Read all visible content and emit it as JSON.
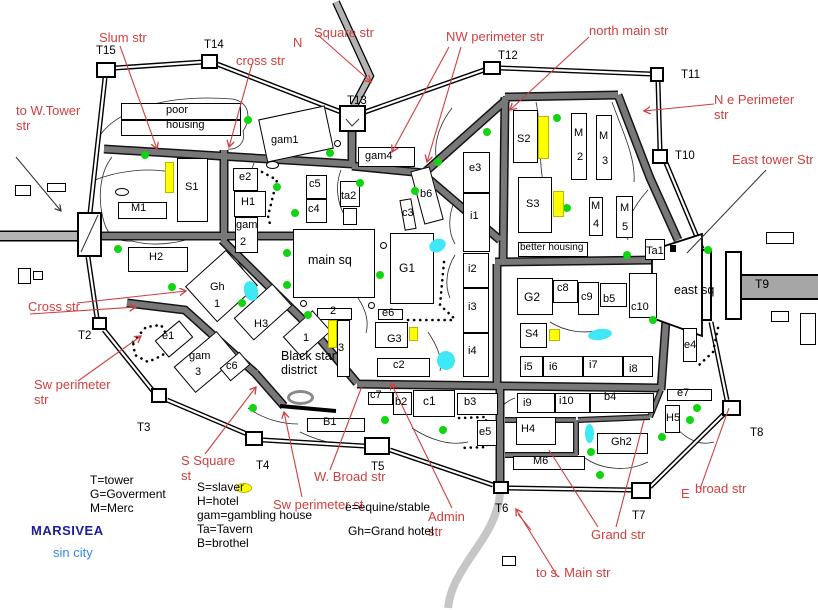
{
  "title": {
    "name": "MARSIVEA",
    "subtitle": "sin city"
  },
  "colors": {
    "red_street_label": "#cf3f3f",
    "navy_title": "#1c1ca0",
    "light_blue_subtitle": "#3b86f0",
    "inner_street": "#787878",
    "outer_road": "#b3b3b3",
    "tree": "#0fd60f",
    "pond": "#3fe8f5",
    "yellow": "#ffff00"
  },
  "legend": {
    "left": [
      "T=tower",
      "G=Goverment",
      "M=Merc"
    ],
    "middle": [
      "S=slaver",
      "H=hotel",
      "gam=gambling house",
      "Ta=Tavern",
      "B=brothel"
    ],
    "right": [
      "e=equine/stable",
      "Gh=Grand hotel"
    ]
  },
  "towers": [
    {
      "id": "T1",
      "x": 77,
      "y": 212,
      "w": 25,
      "h": 45
    },
    {
      "id": "T2",
      "x": 92,
      "y": 317,
      "w": 15,
      "h": 13
    },
    {
      "id": "T3",
      "x": 151,
      "y": 388,
      "w": 16,
      "h": 15
    },
    {
      "id": "T4",
      "x": 245,
      "y": 431,
      "w": 18,
      "h": 15
    },
    {
      "id": "T5",
      "x": 364,
      "y": 437,
      "w": 26,
      "h": 18
    },
    {
      "id": "T6",
      "x": 493,
      "y": 481,
      "w": 16,
      "h": 13
    },
    {
      "id": "T7",
      "x": 631,
      "y": 482,
      "w": 20,
      "h": 17
    },
    {
      "id": "T8",
      "x": 722,
      "y": 400,
      "w": 19,
      "h": 16
    },
    {
      "id": "T9a",
      "x": 701,
      "y": 249,
      "w": 11,
      "h": 72
    },
    {
      "id": "T9b",
      "x": 725,
      "y": 251,
      "w": 17,
      "h": 69
    },
    {
      "id": "T10",
      "x": 652,
      "y": 149,
      "w": 16,
      "h": 15
    },
    {
      "id": "T11",
      "x": 650,
      "y": 67,
      "w": 14,
      "h": 15
    },
    {
      "id": "T12",
      "x": 483,
      "y": 61,
      "w": 18,
      "h": 14
    },
    {
      "id": "T13",
      "x": 339,
      "y": 105,
      "w": 27,
      "h": 27
    },
    {
      "id": "T14",
      "x": 201,
      "y": 54,
      "w": 17,
      "h": 15
    },
    {
      "id": "T15",
      "x": 96,
      "y": 62,
      "w": 20,
      "h": 16
    }
  ],
  "buildings": [
    {
      "l": "poor",
      "x": 121,
      "y": 103,
      "w": 120,
      "h": 17,
      "lx": 166,
      "ly": 105
    },
    {
      "l": "housing",
      "x": 121,
      "y": 120,
      "w": 120,
      "h": 16,
      "lx": 166,
      "ly": 120
    },
    {
      "l": "S1",
      "x": 177,
      "y": 158,
      "w": 31,
      "h": 64,
      "lx": 185,
      "ly": 182
    },
    {
      "l": "M1",
      "x": 118,
      "y": 202,
      "w": 49,
      "h": 17,
      "lx": 131,
      "ly": 203
    },
    {
      "l": "H2",
      "x": 128,
      "y": 247,
      "w": 60,
      "h": 25,
      "lx": 149,
      "ly": 252
    },
    {
      "l": "e2",
      "x": 233,
      "y": 168,
      "w": 25,
      "h": 23,
      "lx": 239,
      "ly": 172
    },
    {
      "l": "H1",
      "x": 234,
      "y": 191,
      "w": 32,
      "h": 26,
      "lx": 241,
      "ly": 197
    },
    {
      "l": "gam",
      "l2": "2",
      "x": 235,
      "y": 217,
      "w": 23,
      "h": 36,
      "lx": 236,
      "ly": 220,
      "l2x": 240,
      "l2y": 237
    },
    {
      "l": "c5",
      "x": 306,
      "y": 175,
      "w": 21,
      "h": 24,
      "lx": 309,
      "ly": 179
    },
    {
      "l": "c4",
      "x": 306,
      "y": 199,
      "w": 21,
      "h": 24,
      "lx": 308,
      "ly": 204
    },
    {
      "l": "ta2",
      "x": 340,
      "y": 181,
      "w": 20,
      "h": 26,
      "lx": 341,
      "ly": 191
    },
    {
      "x": 343,
      "y": 208,
      "w": 14,
      "h": 17
    },
    {
      "l": "gam1",
      "x": 262,
      "y": 112,
      "w": 68,
      "h": 44,
      "r": -12,
      "lx": 271,
      "ly": 135
    },
    {
      "l": "gam4",
      "x": 358,
      "y": 147,
      "w": 57,
      "h": 20,
      "lx": 365,
      "ly": 151
    },
    {
      "l": "b6",
      "x": 417,
      "y": 168,
      "w": 20,
      "h": 55,
      "r": -15,
      "lx": 420,
      "ly": 189
    },
    {
      "l": "c3",
      "x": 402,
      "y": 199,
      "w": 12,
      "h": 31,
      "r": -10,
      "lx": 402,
      "ly": 208
    },
    {
      "l": "main sq",
      "x": 293,
      "y": 229,
      "w": 82,
      "h": 69,
      "lx": 308,
      "ly": 254,
      "lfs": 12.5
    },
    {
      "l": "G1",
      "x": 390,
      "y": 233,
      "w": 44,
      "h": 71,
      "lx": 399,
      "ly": 262,
      "lfs": 12
    },
    {
      "l": "e6",
      "x": 378,
      "y": 309,
      "w": 25,
      "h": 11,
      "lx": 382,
      "ly": 308
    },
    {
      "l": "G3",
      "x": 375,
      "y": 322,
      "w": 33,
      "h": 26,
      "lx": 387,
      "ly": 334
    },
    {
      "l": "c2",
      "x": 377,
      "y": 358,
      "w": 53,
      "h": 19,
      "lx": 393,
      "ly": 360
    },
    {
      "l": "e3",
      "x": 463,
      "y": 152,
      "w": 27,
      "h": 41,
      "lx": 469,
      "ly": 163
    },
    {
      "l": "i1",
      "x": 463,
      "y": 193,
      "w": 27,
      "h": 59,
      "lx": 470,
      "ly": 211
    },
    {
      "l": "i2",
      "x": 463,
      "y": 253,
      "w": 26,
      "h": 35,
      "lx": 468,
      "ly": 264
    },
    {
      "l": "i3",
      "x": 463,
      "y": 288,
      "w": 26,
      "h": 45,
      "lx": 468,
      "ly": 302
    },
    {
      "l": "i4",
      "x": 463,
      "y": 333,
      "w": 26,
      "h": 44,
      "lx": 468,
      "ly": 346
    },
    {
      "l": "S2",
      "x": 513,
      "y": 110,
      "w": 25,
      "h": 53,
      "lx": 517,
      "ly": 134
    },
    {
      "l": "M",
      "l2": "2",
      "x": 571,
      "y": 113,
      "w": 16,
      "h": 67,
      "lx": 574,
      "ly": 128,
      "l2x": 577,
      "l2y": 152
    },
    {
      "l": "M",
      "l2": "3",
      "x": 596,
      "y": 115,
      "w": 16,
      "h": 65,
      "lx": 599,
      "ly": 131,
      "l2x": 602,
      "l2y": 156
    },
    {
      "l": "S3",
      "x": 518,
      "y": 177,
      "w": 34,
      "h": 56,
      "lx": 526,
      "ly": 199
    },
    {
      "l": "M",
      "l2": "4",
      "x": 589,
      "y": 197,
      "w": 14,
      "h": 39,
      "lx": 591,
      "ly": 201,
      "l2x": 593,
      "l2y": 219
    },
    {
      "l": "M",
      "l2": "5",
      "x": 616,
      "y": 196,
      "w": 17,
      "h": 42,
      "lx": 620,
      "ly": 203,
      "l2x": 622,
      "l2y": 222
    },
    {
      "l": "better housing",
      "x": 518,
      "y": 242,
      "w": 70,
      "h": 15,
      "lx": 520,
      "ly": 243,
      "lfs": 10
    },
    {
      "l": "Ta1",
      "x": 645,
      "y": 239,
      "w": 20,
      "h": 21,
      "lx": 646,
      "ly": 246
    },
    {
      "l": "G2",
      "x": 517,
      "y": 278,
      "w": 36,
      "h": 37,
      "lx": 524,
      "ly": 291,
      "lfs": 12
    },
    {
      "l": "c8",
      "x": 553,
      "y": 280,
      "w": 25,
      "h": 23,
      "lx": 557,
      "ly": 283
    },
    {
      "l": "c9",
      "x": 578,
      "y": 282,
      "w": 21,
      "h": 33,
      "lx": 581,
      "ly": 292
    },
    {
      "l": "b5",
      "x": 600,
      "y": 283,
      "w": 27,
      "h": 24,
      "lx": 603,
      "ly": 294
    },
    {
      "l": "c10",
      "x": 629,
      "y": 273,
      "w": 28,
      "h": 45,
      "lx": 631,
      "ly": 302
    },
    {
      "l": "S4",
      "x": 520,
      "y": 323,
      "w": 27,
      "h": 25,
      "lx": 525,
      "ly": 329
    },
    {
      "l": "i5",
      "x": 520,
      "y": 356,
      "w": 23,
      "h": 21,
      "lx": 524,
      "ly": 362
    },
    {
      "l": "i6",
      "x": 543,
      "y": 356,
      "w": 40,
      "h": 21,
      "lx": 549,
      "ly": 362
    },
    {
      "l": "i7",
      "x": 583,
      "y": 356,
      "w": 40,
      "h": 21,
      "lx": 589,
      "ly": 360
    },
    {
      "l": "i8",
      "x": 623,
      "y": 356,
      "w": 30,
      "h": 21,
      "lx": 629,
      "ly": 364
    },
    {
      "l": "i9",
      "x": 517,
      "y": 393,
      "w": 38,
      "h": 20,
      "lx": 523,
      "ly": 398
    },
    {
      "l": "i10",
      "x": 555,
      "y": 393,
      "w": 35,
      "h": 20,
      "lx": 559,
      "ly": 396
    },
    {
      "l": "b4",
      "x": 590,
      "y": 393,
      "w": 64,
      "h": 20,
      "lx": 604,
      "ly": 392
    },
    {
      "l": "H4",
      "x": 516,
      "y": 417,
      "w": 40,
      "h": 28,
      "lx": 521,
      "ly": 424
    },
    {
      "l": "M6",
      "x": 513,
      "y": 456,
      "w": 72,
      "h": 14,
      "lx": 533,
      "ly": 456
    },
    {
      "l": "Gh2",
      "x": 597,
      "y": 433,
      "w": 51,
      "h": 21,
      "lx": 611,
      "ly": 437
    },
    {
      "l": "H5",
      "x": 665,
      "y": 405,
      "w": 15,
      "h": 28,
      "lx": 666,
      "ly": 413
    },
    {
      "l": "e7",
      "x": 667,
      "y": 389,
      "w": 45,
      "h": 12,
      "lx": 677,
      "ly": 388
    },
    {
      "l": "e4",
      "x": 683,
      "y": 328,
      "w": 14,
      "h": 34,
      "lx": 684,
      "ly": 340
    },
    {
      "l": "e5",
      "x": 477,
      "y": 420,
      "w": 20,
      "h": 26,
      "lx": 479,
      "ly": 427
    },
    {
      "l": "c7",
      "x": 368,
      "y": 392,
      "w": 25,
      "h": 13,
      "lx": 370,
      "ly": 390
    },
    {
      "l": "b2",
      "x": 393,
      "y": 392,
      "w": 19,
      "h": 23,
      "lx": 395,
      "ly": 397
    },
    {
      "l": "c1",
      "x": 413,
      "y": 390,
      "w": 42,
      "h": 27,
      "lx": 423,
      "ly": 395,
      "lfs": 12
    },
    {
      "l": "b3",
      "x": 457,
      "y": 393,
      "w": 41,
      "h": 22,
      "lx": 464,
      "ly": 397
    },
    {
      "l": "B1",
      "x": 307,
      "y": 418,
      "w": 58,
      "h": 14,
      "lx": 323,
      "ly": 417
    },
    {
      "l": "2",
      "x": 317,
      "y": 308,
      "w": 35,
      "h": 12,
      "lx": 330,
      "ly": 306
    },
    {
      "l": "3",
      "x": 337,
      "y": 320,
      "w": 13,
      "h": 57,
      "lx": 338,
      "ly": 343
    },
    {
      "l": "1",
      "x": 287,
      "y": 320,
      "w": 40,
      "h": 28,
      "r": -42,
      "lx": 303,
      "ly": 333
    },
    {
      "l": "Gh",
      "l2": "1",
      "x": 194,
      "y": 262,
      "w": 55,
      "h": 48,
      "r": -42,
      "lx": 210,
      "ly": 282,
      "l2x": 214,
      "l2y": 299
    },
    {
      "l": "H3",
      "x": 237,
      "y": 297,
      "w": 52,
      "h": 30,
      "r": -42,
      "lx": 254,
      "ly": 319
    },
    {
      "l": "e1",
      "x": 158,
      "y": 328,
      "w": 32,
      "h": 22,
      "r": -40,
      "lx": 162,
      "ly": 331
    },
    {
      "l": "gam",
      "l2": "3",
      "x": 178,
      "y": 345,
      "w": 56,
      "h": 34,
      "r": -40,
      "lx": 189,
      "ly": 351,
      "l2x": 195,
      "l2y": 367
    },
    {
      "l": "c6",
      "x": 222,
      "y": 358,
      "w": 26,
      "h": 17,
      "r": -40,
      "lx": 226,
      "ly": 361
    }
  ],
  "outbuildings": [
    {
      "x": 15,
      "y": 185,
      "w": 16,
      "h": 11
    },
    {
      "x": 47,
      "y": 183,
      "w": 19,
      "h": 9
    },
    {
      "x": 18,
      "y": 268,
      "w": 13,
      "h": 16
    },
    {
      "x": 33,
      "y": 271,
      "w": 10,
      "h": 9
    },
    {
      "x": 766,
      "y": 232,
      "w": 28,
      "h": 12
    },
    {
      "x": 771,
      "y": 311,
      "w": 18,
      "h": 11
    },
    {
      "x": 800,
      "y": 313,
      "w": 16,
      "h": 32
    },
    {
      "x": 502,
      "y": 556,
      "w": 14,
      "h": 10
    }
  ],
  "black_squares": [
    {
      "x": 670,
      "y": 245,
      "w": 6,
      "h": 7
    }
  ],
  "trees": [
    [
      145,
      155
    ],
    [
      248,
      120
    ],
    [
      330,
      153
    ],
    [
      438,
      162
    ],
    [
      557,
      118
    ],
    [
      487,
      132
    ],
    [
      567,
      208
    ],
    [
      277,
      187
    ],
    [
      360,
      183
    ],
    [
      415,
      191
    ],
    [
      295,
      213
    ],
    [
      118,
      249
    ],
    [
      172,
      287
    ],
    [
      287,
      253
    ],
    [
      287,
      285
    ],
    [
      380,
      275
    ],
    [
      242,
      303
    ],
    [
      627,
      255
    ],
    [
      653,
      320
    ],
    [
      708,
      250
    ],
    [
      308,
      315
    ],
    [
      253,
      408
    ],
    [
      385,
      420
    ],
    [
      443,
      430
    ],
    [
      697,
      408
    ],
    [
      690,
      420
    ],
    [
      662,
      437
    ],
    [
      591,
      452
    ],
    [
      600,
      475
    ]
  ],
  "ponds": [
    {
      "x": 244,
      "y": 281,
      "w": 14,
      "h": 20,
      "r": -15
    },
    {
      "x": 429,
      "y": 239,
      "w": 17,
      "h": 13,
      "r": -25
    },
    {
      "x": 437,
      "y": 351,
      "w": 18,
      "h": 19,
      "r": 0
    },
    {
      "x": 588,
      "y": 329,
      "w": 24,
      "h": 11,
      "r": -8
    },
    {
      "x": 585,
      "y": 424,
      "w": 9,
      "h": 19,
      "r": 0
    }
  ],
  "yellow_marks": [
    {
      "x": 165,
      "y": 162,
      "w": 9,
      "h": 31
    },
    {
      "x": 538,
      "y": 116,
      "w": 11,
      "h": 43
    },
    {
      "x": 553,
      "y": 191,
      "w": 11,
      "h": 26
    },
    {
      "x": 549,
      "y": 329,
      "w": 11,
      "h": 12
    },
    {
      "x": 328,
      "y": 320,
      "w": 9,
      "h": 28
    },
    {
      "x": 409,
      "y": 327,
      "w": 9,
      "h": 14
    },
    {
      "x": 236,
      "y": 483,
      "w": 16,
      "h": 10,
      "round": 1
    }
  ],
  "circles": [
    [
      371,
      305
    ],
    [
      383,
      245
    ],
    [
      337,
      143
    ],
    [
      303,
      303
    ]
  ],
  "ovals": [
    {
      "x": 115,
      "y": 188,
      "w": 14,
      "h": 8
    },
    {
      "x": 266,
      "y": 161,
      "w": 13,
      "h": 8
    }
  ],
  "gray_oval": {
    "x": 287,
    "y": 390,
    "w": 27,
    "h": 15
  },
  "labels": [
    {
      "t": "Slum str",
      "x": 99,
      "y": 31,
      "c": "red",
      "fs": 13
    },
    {
      "t": "cross str",
      "x": 236,
      "y": 54,
      "c": "red",
      "fs": 13
    },
    {
      "t": "N",
      "x": 293,
      "y": 36,
      "c": "red",
      "fs": 13
    },
    {
      "t": "Square str",
      "x": 314,
      "y": 26,
      "c": "red",
      "fs": 13
    },
    {
      "t": "NW perimeter str",
      "x": 446,
      "y": 30,
      "c": "red",
      "fs": 13
    },
    {
      "t": "north main str",
      "x": 589,
      "y": 24,
      "c": "red",
      "fs": 13
    },
    {
      "t": "N e Perimeter\nstr",
      "x": 714,
      "y": 93,
      "c": "red",
      "fs": 13
    },
    {
      "t": "East tower Str",
      "x": 732,
      "y": 153,
      "c": "red",
      "fs": 13
    },
    {
      "t": "to W.Tower\nstr",
      "x": 16,
      "y": 104,
      "c": "red",
      "fs": 13
    },
    {
      "t": "Cross str",
      "x": 28,
      "y": 300,
      "c": "red",
      "fs": 13
    },
    {
      "t": "Sw perimeter\nstr",
      "x": 34,
      "y": 378,
      "c": "red",
      "fs": 13
    },
    {
      "t": "S Square\nst",
      "x": 181,
      "y": 454,
      "c": "red",
      "fs": 13
    },
    {
      "t": "Sw perimeter st",
      "x": 273,
      "y": 498,
      "c": "red",
      "fs": 13
    },
    {
      "t": "W. Broad str",
      "x": 314,
      "y": 470,
      "c": "red",
      "fs": 13
    },
    {
      "t": "Admin\nstr",
      "x": 428,
      "y": 510,
      "c": "red",
      "fs": 13
    },
    {
      "t": "Grand str",
      "x": 591,
      "y": 528,
      "c": "red",
      "fs": 13
    },
    {
      "t": "broad str",
      "x": 695,
      "y": 482,
      "c": "red",
      "fs": 13
    },
    {
      "t": "E",
      "x": 681,
      "y": 487,
      "c": "red",
      "fs": 13
    },
    {
      "t": "to s. Main str",
      "x": 536,
      "y": 566,
      "c": "red",
      "fs": 13
    },
    {
      "t": "T15",
      "x": 96,
      "y": 45,
      "c": "blk",
      "fs": 11.5
    },
    {
      "t": "T14",
      "x": 204,
      "y": 39,
      "c": "blk",
      "fs": 11.5
    },
    {
      "t": "T13",
      "x": 347,
      "y": 95,
      "c": "blk",
      "fs": 11.5
    },
    {
      "t": "T12",
      "x": 498,
      "y": 50,
      "c": "blk",
      "fs": 11.5
    },
    {
      "t": "T11",
      "x": 681,
      "y": 69,
      "c": "blk",
      "fs": 11.5
    },
    {
      "t": "T10",
      "x": 675,
      "y": 150,
      "c": "blk",
      "fs": 11.5
    },
    {
      "t": "T9",
      "x": 755,
      "y": 278,
      "c": "blk",
      "fs": 12
    },
    {
      "t": "T8",
      "x": 750,
      "y": 427,
      "c": "blk",
      "fs": 11.5
    },
    {
      "t": "T7",
      "x": 632,
      "y": 510,
      "c": "blk",
      "fs": 11.5
    },
    {
      "t": "T6",
      "x": 495,
      "y": 503,
      "c": "blk",
      "fs": 11.5
    },
    {
      "t": "T5",
      "x": 371,
      "y": 461,
      "c": "blk",
      "fs": 11.5
    },
    {
      "t": "T4",
      "x": 256,
      "y": 460,
      "c": "blk",
      "fs": 11.5
    },
    {
      "t": "T3",
      "x": 137,
      "y": 422,
      "c": "blk",
      "fs": 11.5
    },
    {
      "t": "T2",
      "x": 78,
      "y": 330,
      "c": "blk",
      "fs": 11.5
    },
    {
      "t": "east sq",
      "x": 674,
      "y": 283,
      "c": "blk",
      "fs": 12.5
    },
    {
      "t": "Black star\ndistrict",
      "x": 281,
      "y": 349,
      "c": "blk",
      "fs": 12.5
    },
    {
      "t": "T=tower",
      "x": 90,
      "y": 474,
      "c": "blk",
      "fs": 12
    },
    {
      "t": "G=Goverment",
      "x": 90,
      "y": 488,
      "c": "blk",
      "fs": 12
    },
    {
      "t": "M=Merc",
      "x": 90,
      "y": 502,
      "c": "blk",
      "fs": 12
    },
    {
      "t": "S=slaver",
      "x": 197,
      "y": 481,
      "c": "blk",
      "fs": 12
    },
    {
      "t": "H=hotel",
      "x": 197,
      "y": 495,
      "c": "blk",
      "fs": 12
    },
    {
      "t": "gam=gambling house",
      "x": 197,
      "y": 509,
      "c": "blk",
      "fs": 12
    },
    {
      "t": "Ta=Tavern",
      "x": 197,
      "y": 523,
      "c": "blk",
      "fs": 12
    },
    {
      "t": "B=brothel",
      "x": 197,
      "y": 537,
      "c": "blk",
      "fs": 12
    },
    {
      "t": "e=equine/stable",
      "x": 345,
      "y": 501,
      "c": "blk",
      "fs": 12
    },
    {
      "t": "Gh=Grand hotel",
      "x": 348,
      "y": 525,
      "c": "blk",
      "fs": 12
    },
    {
      "t": "MARSIVEA",
      "x": 31,
      "y": 524,
      "c": "navy",
      "fs": 13,
      "b": 1
    },
    {
      "t": "sin city",
      "x": 53,
      "y": 546,
      "c": "ltblue",
      "fs": 13
    }
  ]
}
